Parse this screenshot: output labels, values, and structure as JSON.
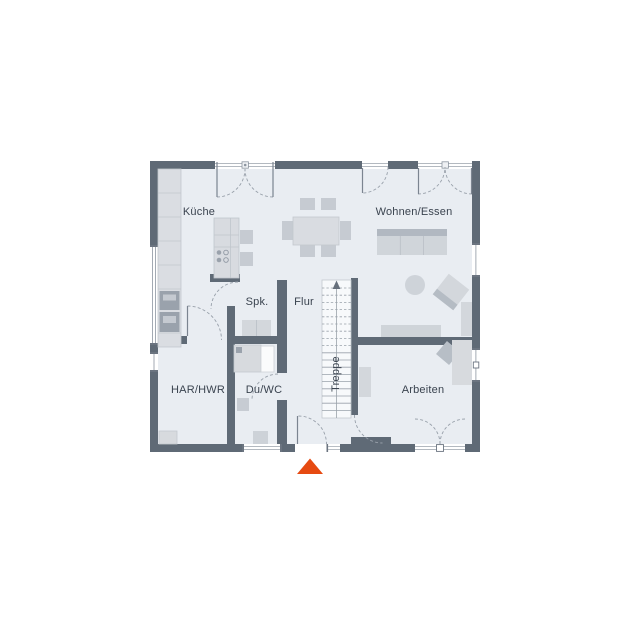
{
  "floor_plan": {
    "type": "residential-ground-floor-plan",
    "rooms": [
      {
        "name": "kueche",
        "label": "Küche"
      },
      {
        "name": "wohnen-essen",
        "label": "Wohnen/Essen"
      },
      {
        "name": "spk",
        "label": "Spk."
      },
      {
        "name": "flur",
        "label": "Flur"
      },
      {
        "name": "treppe",
        "label": "Treppe"
      },
      {
        "name": "har-hwr",
        "label": "HAR/HWR"
      },
      {
        "name": "du-wc",
        "label": "Du/WC"
      },
      {
        "name": "arbeiten",
        "label": "Arbeiten"
      }
    ],
    "colors": {
      "wall": "#5f6a76",
      "floor": "#e9edf2",
      "furniture_light": "#d4d8dd",
      "furniture_mid": "#c6cbd2",
      "entrance_arrow": "#e64a12"
    },
    "markers": {
      "entrance_arrow": "triangle-up",
      "stairs_direction": "up"
    }
  }
}
